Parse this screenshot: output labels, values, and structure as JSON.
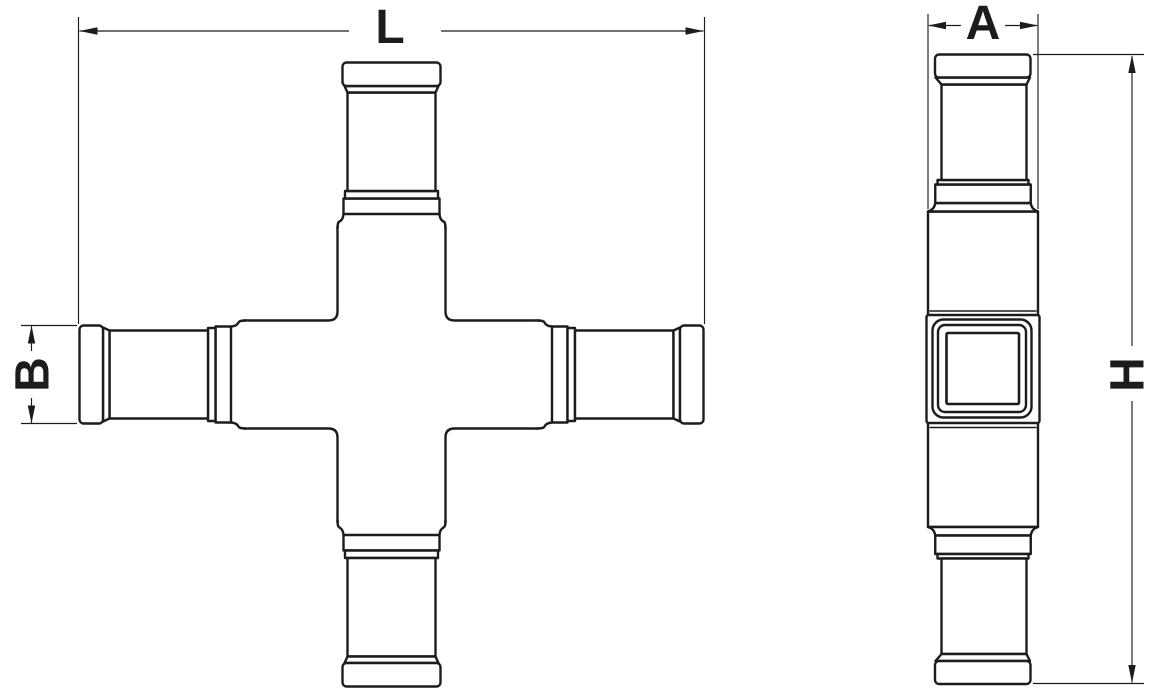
{
  "document": {
    "title": "Cross pipe fitting dimensional drawing",
    "background": "#ffffff"
  },
  "colors": {
    "line": "#1c1c1c",
    "background": "#ffffff"
  },
  "views": {
    "front": {
      "name": "front-view-cross-fitting",
      "dimensions": {
        "overall_length": {
          "label": "L",
          "orientation": "horizontal"
        },
        "end_diameter": {
          "label": "B",
          "orientation": "vertical"
        }
      }
    },
    "side": {
      "name": "side-view-profile",
      "dimensions": {
        "body_width": {
          "label": "A",
          "orientation": "horizontal"
        },
        "overall_height": {
          "label": "H",
          "orientation": "vertical"
        }
      }
    }
  }
}
